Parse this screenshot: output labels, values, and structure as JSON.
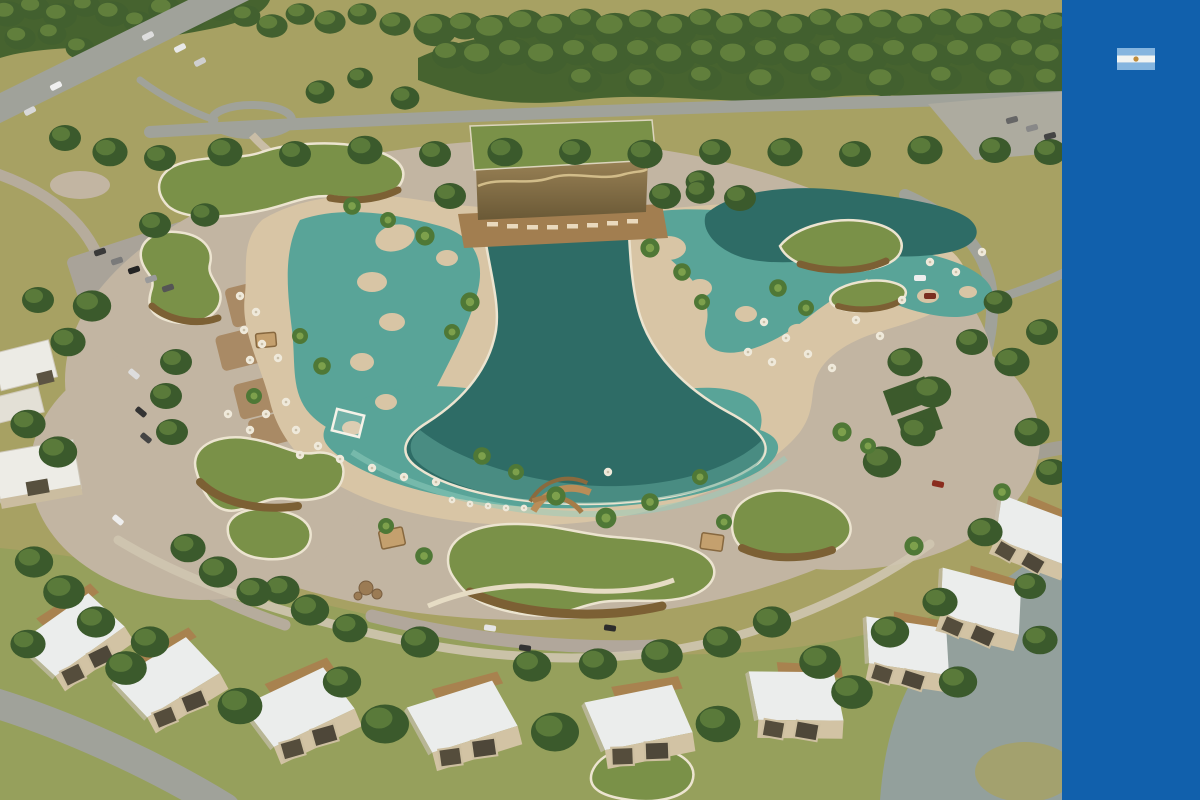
{
  "scene": {
    "description": "Aerial 3D architectural render of a surf-park resort: central funnel-shaped wave pool lagoon with cream retaining walls, turquoise shallows, palm-dotted sand islands, green-roofed organic pavilions, a slatted-wood surf lodge, beach umbrellas, perimeter roads and an arc of white flat-roofed cabins",
    "palette": {
      "field": "#a7a163",
      "grass": "#96a05c",
      "forest": "#46632f",
      "road": "#a0a29a",
      "ground": "#c2b5a2",
      "sand": "#d8c5a5",
      "water_shallow": "#59a498",
      "water_deep": "#2e6c66",
      "pool_wall": "#ece4d0",
      "roof_green": "#7a9148",
      "wood": "#7c6034",
      "deck": "#a27e50",
      "house_roof": "#ebedec",
      "house_wall": "#d2c3a4"
    }
  },
  "sidebar": {
    "background": "#1160ac",
    "flag": {
      "country": "argentina",
      "stripe_blue": "#85b5df",
      "stripe_white": "#f1f4f2",
      "sun": "#bf8c3c"
    }
  }
}
